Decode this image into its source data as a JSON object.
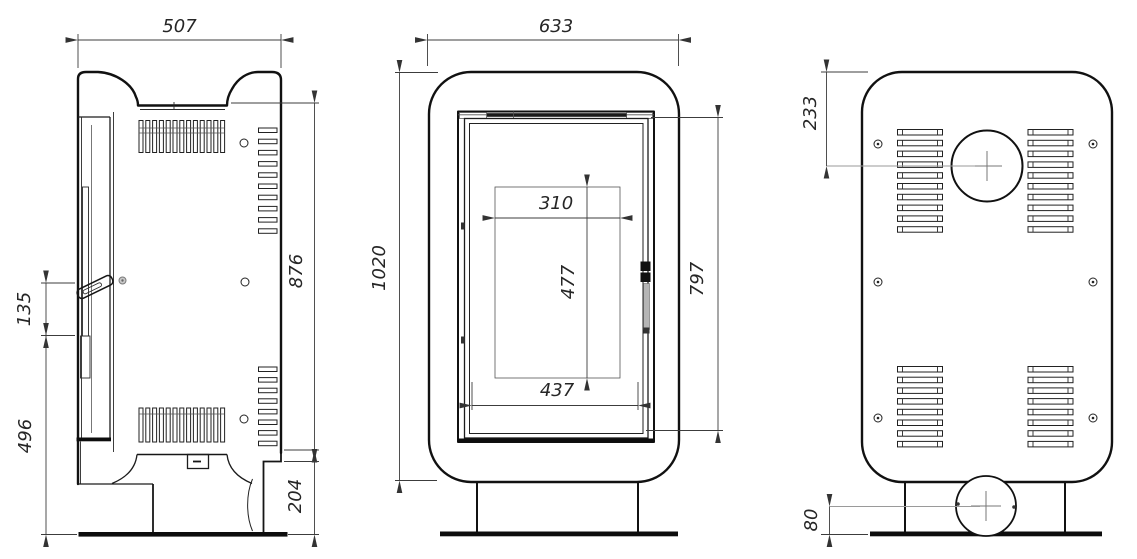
{
  "drawing": {
    "side": {
      "width": "507",
      "handle_zone": "135",
      "front_height": "496",
      "body_height": "876",
      "plinth_height": "204"
    },
    "front": {
      "width": "633",
      "total_height": "1020",
      "glass_width": "310",
      "glass_height": "477",
      "door_width": "437",
      "door_height": "797"
    },
    "back": {
      "flue_offset": "233",
      "intake_height": "80"
    }
  }
}
